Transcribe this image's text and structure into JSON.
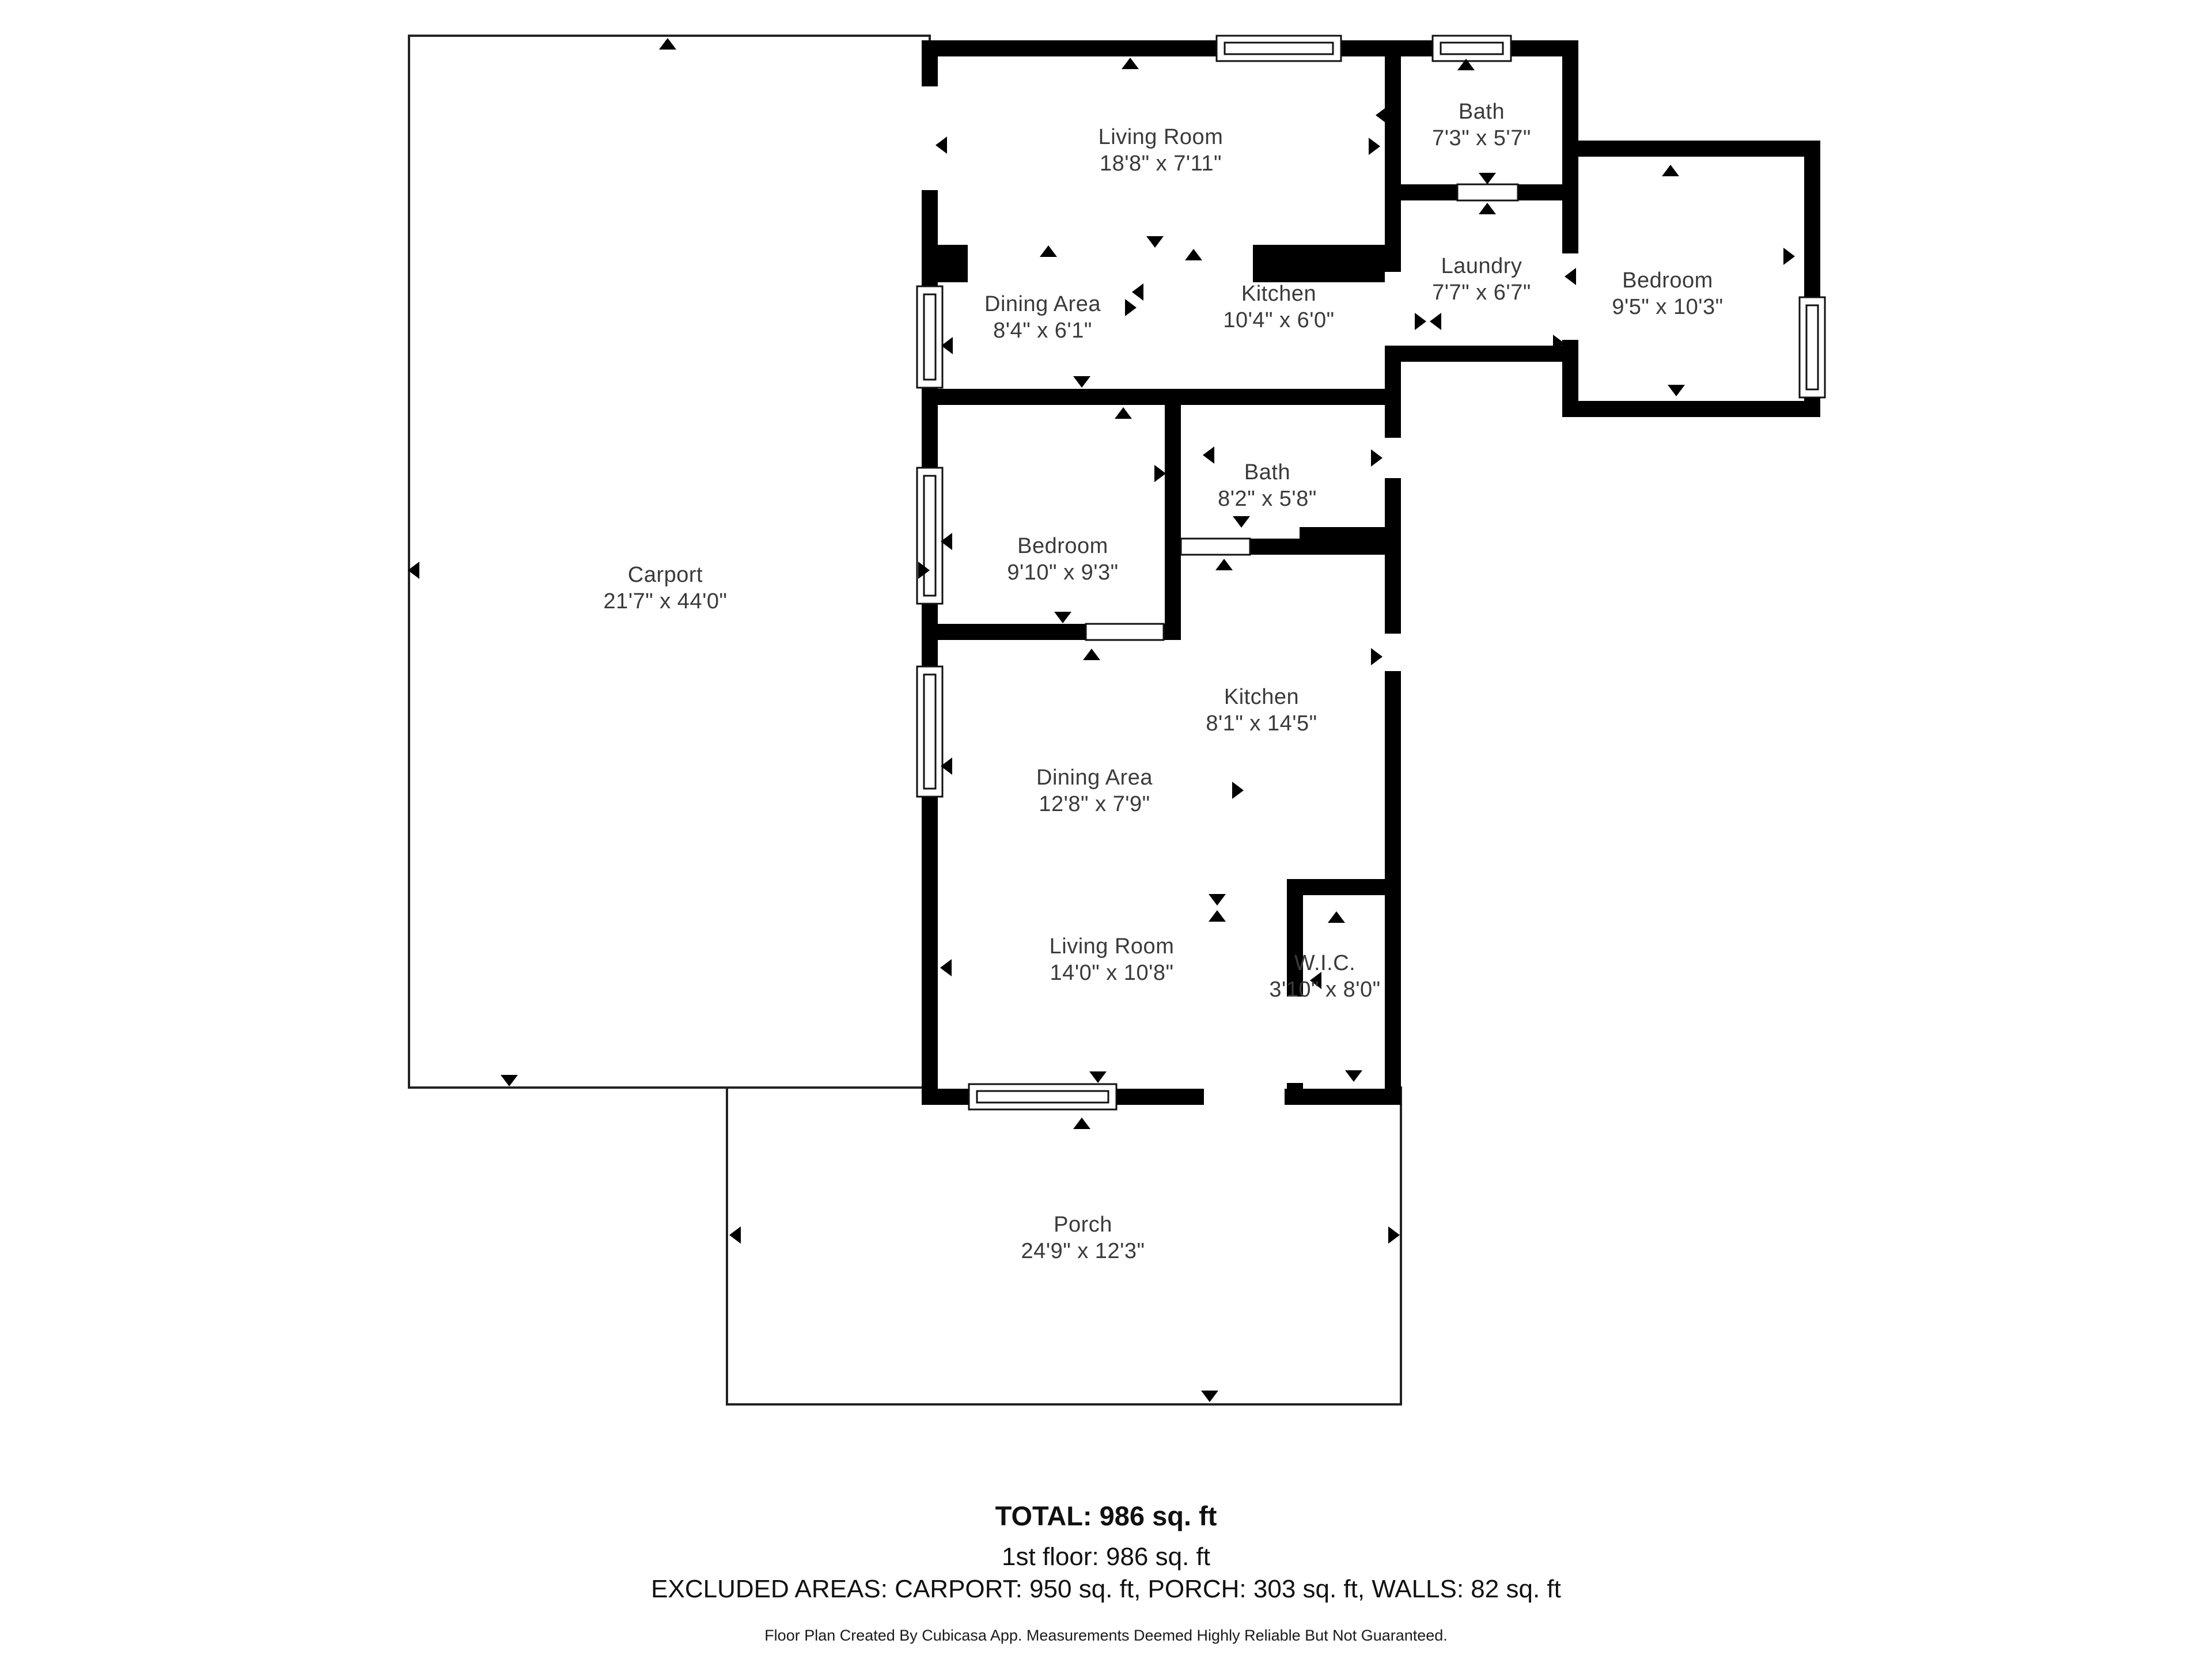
{
  "page": {
    "background": "#ffffff"
  },
  "floor_plan": {
    "rooms": {
      "living_room_top": {
        "name": "Living Room",
        "dims": "18'8\" x 7'11\""
      },
      "bath_top": {
        "name": "Bath",
        "dims": "7'3\" x 5'7\""
      },
      "laundry": {
        "name": "Laundry",
        "dims": "7'7\" x 6'7\""
      },
      "bedroom_right": {
        "name": "Bedroom",
        "dims": "9'5\" x 10'3\""
      },
      "dining_area_top": {
        "name": "Dining Area",
        "dims": "8'4\" x 6'1\""
      },
      "kitchen_top": {
        "name": "Kitchen",
        "dims": "10'4\" x 6'0\""
      },
      "bedroom_middle": {
        "name": "Bedroom",
        "dims": "9'10\" x 9'3\""
      },
      "bath_middle": {
        "name": "Bath",
        "dims": "8'2\" x 5'8\""
      },
      "kitchen_middle": {
        "name": "Kitchen",
        "dims": "8'1\" x 14'5\""
      },
      "dining_area_middle": {
        "name": "Dining Area",
        "dims": "12'8\" x 7'9\""
      },
      "living_room_bottom": {
        "name": "Living Room",
        "dims": "14'0\" x 10'8\""
      },
      "wic": {
        "name": "W.I.C.",
        "dims": "3'10\" x 8'0\""
      },
      "carport": {
        "name": "Carport",
        "dims": "21'7\" x 44'0\""
      },
      "porch": {
        "name": "Porch",
        "dims": "24'9\" x 12'3\""
      }
    },
    "colors": {
      "wall": "#000000",
      "room_fill": "#ffffff",
      "label_text": "#3a3a3a",
      "thin_outline": "#222222"
    },
    "icons": {
      "direction_arrow": "▲",
      "window": "double-line wall inset",
      "door": "white slab in wall"
    }
  },
  "summary": {
    "total": "TOTAL: 986 sq. ft",
    "first_floor": "1st floor: 986 sq. ft",
    "excluded_areas": "EXCLUDED AREAS: CARPORT: 950 sq. ft, PORCH: 303 sq. ft, WALLS: 82 sq. ft",
    "disclaimer": "Floor Plan Created By Cubicasa App. Measurements Deemed Highly Reliable But Not Guaranteed."
  }
}
